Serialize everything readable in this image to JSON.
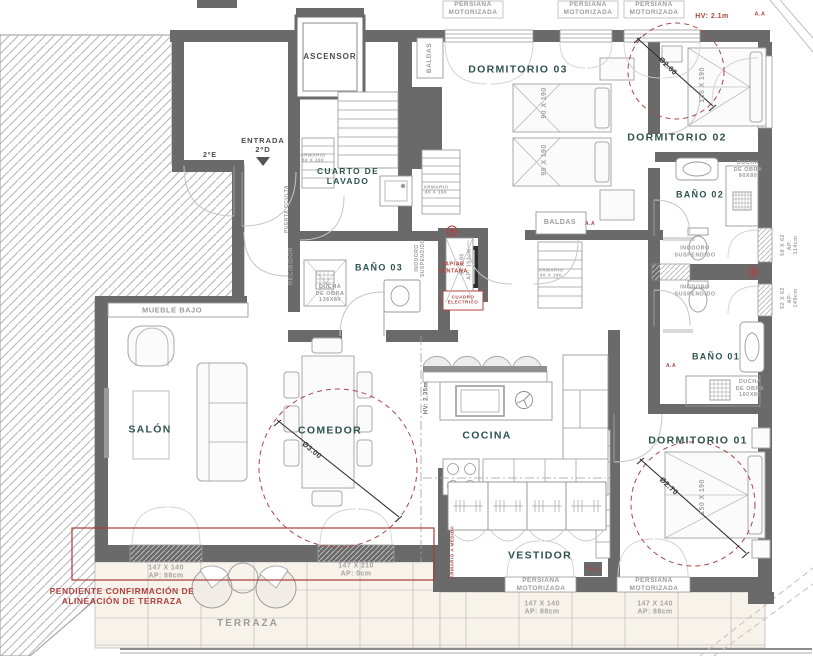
{
  "canvas": {
    "width": 813,
    "height": 656
  },
  "colors": {
    "wall": "#6a6a6a",
    "accent_red": "#b2423e",
    "room_label": "#2e544a",
    "muted_label": "#9c9c9c",
    "tile_bg": "#f7f2ea"
  },
  "labels": [
    {
      "n": "label-salon",
      "c": "room",
      "x": 150,
      "y": 430,
      "t": "SALÓN"
    },
    {
      "n": "label-comedor",
      "c": "room",
      "x": 330,
      "y": 431,
      "t": "COMEDOR"
    },
    {
      "n": "label-cocina",
      "c": "room",
      "x": 487,
      "y": 436,
      "t": "COCINA"
    },
    {
      "n": "label-vestidor",
      "c": "room",
      "x": 540,
      "y": 556,
      "t": "VESTIDOR"
    },
    {
      "n": "label-dormitorio-01",
      "c": "room",
      "x": 698,
      "y": 441,
      "t": "DORMITORIO 01"
    },
    {
      "n": "label-dormitorio-02",
      "c": "room",
      "x": 677,
      "y": 138,
      "t": "DORMITORIO 02"
    },
    {
      "n": "label-dormitorio-03",
      "c": "room",
      "x": 518,
      "y": 70,
      "t": "DORMITORIO 03"
    },
    {
      "n": "label-bano-01",
      "c": "room",
      "x": 716,
      "y": 357,
      "t": "BAÑO 01",
      "fs": 9
    },
    {
      "n": "label-bano-02",
      "c": "room",
      "x": 700,
      "y": 195,
      "t": "BAÑO 02",
      "fs": 9
    },
    {
      "n": "label-bano-03",
      "c": "room",
      "x": 379,
      "y": 268,
      "t": "BAÑO 03",
      "fs": 9
    },
    {
      "n": "label-cuarto-lavado",
      "c": "room",
      "x": 348,
      "y": 176,
      "t": "CUARTO DE\nLAVADO",
      "fs": 8.5
    },
    {
      "n": "label-ascensor",
      "c": "dark",
      "x": 330,
      "y": 57,
      "t": "ASCENSOR"
    },
    {
      "n": "label-entrada",
      "c": "dark",
      "x": 263,
      "y": 145,
      "t": "ENTRADA\n2ºD",
      "fs": 7.5
    },
    {
      "n": "label-piso-2e",
      "c": "dark",
      "x": 210,
      "y": 156,
      "t": "2ºE",
      "fs": 7
    },
    {
      "n": "label-persiana-1",
      "c": "small",
      "x": 473,
      "y": 9,
      "t": "PERSIANA\nMOTORIZADA"
    },
    {
      "n": "label-persiana-2",
      "c": "small",
      "x": 588,
      "y": 9,
      "t": "PERSIANA\nMOTORIZADA"
    },
    {
      "n": "label-persiana-3",
      "c": "small",
      "x": 654,
      "y": 9,
      "t": "PERSIANA\nMOTORIZADA"
    },
    {
      "n": "label-persiana-vestidor",
      "c": "small",
      "x": 541,
      "y": 585,
      "t": "PERSIANA\nMOTORIZADA"
    },
    {
      "n": "label-persiana-dorm01",
      "c": "small",
      "x": 654,
      "y": 585,
      "t": "PERSIANA\nMOTORIZADA"
    },
    {
      "n": "label-mueble-bajo",
      "c": "small",
      "x": 172,
      "y": 310,
      "t": "MUEBLE BAJO",
      "fs": 7.5
    },
    {
      "n": "label-baldas-top",
      "c": "small",
      "x": 430,
      "y": 58,
      "r": -90,
      "t": "BALDAS"
    },
    {
      "n": "label-baldas-mid",
      "c": "small",
      "x": 560,
      "y": 223,
      "t": "BALDAS",
      "fs": 7
    },
    {
      "n": "label-recibidor",
      "c": "small",
      "x": 292,
      "y": 266,
      "r": -90,
      "t": "RECIBIDOR",
      "fs": 6
    },
    {
      "n": "label-puerta-oculta",
      "c": "small",
      "x": 287,
      "y": 209,
      "r": -90,
      "t": "PUERTA OCULTA",
      "fs": 5
    },
    {
      "n": "label-inodoro-b3",
      "c": "small",
      "x": 420,
      "y": 258,
      "r": -90,
      "t": "INODORO\nSUSPENDIDO",
      "fs": 5
    },
    {
      "n": "label-inodoro-b2a",
      "c": "small",
      "x": 695,
      "y": 252,
      "t": "INODORO\nSUSPENDIDO",
      "fs": 5.5
    },
    {
      "n": "label-inodoro-b2b",
      "c": "small",
      "x": 695,
      "y": 291,
      "t": "INODORO\nSUSPENDIDO",
      "fs": 5.5
    },
    {
      "n": "label-ducha-b2",
      "c": "small",
      "x": 748,
      "y": 170,
      "t": "DUCHA\nDE OBRA\n90X80",
      "fs": 5.5
    },
    {
      "n": "label-ducha-b1",
      "c": "small",
      "x": 750,
      "y": 389,
      "t": "DUCHA\nDE OBRA\n160X80",
      "fs": 5.5
    },
    {
      "n": "label-ducha-b3",
      "c": "small",
      "x": 330,
      "y": 294,
      "t": "DUCHA\nDE OBRA\n136X80",
      "fs": 5.5
    },
    {
      "n": "label-armario-lavadero",
      "c": "small",
      "x": 313,
      "y": 158,
      "t": "ARMARIO\n60 X 190",
      "fs": 4.5
    },
    {
      "n": "label-armario-pasillo",
      "c": "small",
      "x": 436,
      "y": 190,
      "t": "ARMARIO\n60 X 190",
      "fs": 4.5
    },
    {
      "n": "label-armario-baldas",
      "c": "small",
      "x": 551,
      "y": 273,
      "t": "ARMARIO\n60 X 190",
      "fs": 4.5
    },
    {
      "n": "label-hv-cocina",
      "c": "smalld",
      "x": 427,
      "y": 398,
      "r": -90,
      "t": "HV: 2.35m"
    },
    {
      "n": "label-terraza",
      "c": "small",
      "x": 248,
      "y": 624,
      "t": "TERRAZA",
      "fs": 10,
      "ls": 2
    },
    {
      "n": "label-cama-d3-1",
      "c": "dim",
      "x": 545,
      "y": 103,
      "r": -90,
      "t": "90 X 190"
    },
    {
      "n": "label-cama-d3-2",
      "c": "dim",
      "x": 545,
      "y": 160,
      "r": -90,
      "t": "90 X 190"
    },
    {
      "n": "label-cama-d2",
      "c": "dim",
      "x": 703,
      "y": 85,
      "r": -90,
      "t": "135 X 190"
    },
    {
      "n": "label-cama-d1",
      "c": "dim",
      "x": 703,
      "y": 497,
      "r": -90,
      "t": "150 X 190"
    },
    {
      "n": "label-ventana-58",
      "c": "dim",
      "x": 790,
      "y": 245,
      "r": -90,
      "t": "58 X 62\nAP: 114cm",
      "fs": 5.5
    },
    {
      "n": "label-ventana-62",
      "c": "dim",
      "x": 790,
      "y": 298,
      "r": -90,
      "t": "62 X 62\nAP: 149cm",
      "fs": 5.5
    },
    {
      "n": "label-ventana-56",
      "c": "dim",
      "x": 466,
      "y": 264,
      "r": -90,
      "t": "56 X 95\nAP: 153cm",
      "fs": 5.5
    },
    {
      "n": "label-ventana-salon",
      "c": "dim",
      "x": 166,
      "y": 573,
      "t": "147 X 140\nAP: 88cm"
    },
    {
      "n": "label-ventana-comedor",
      "c": "dim",
      "x": 356,
      "y": 571,
      "t": "147 X 210\nAP: 0cm"
    },
    {
      "n": "label-ventana-vestidor",
      "c": "dim",
      "x": 542,
      "y": 609,
      "t": "147 X 140\nAP: 88cm"
    },
    {
      "n": "label-ventana-dorm01",
      "c": "dim",
      "x": 655,
      "y": 609,
      "t": "147 X 140\nAP: 88cm"
    },
    {
      "n": "label-diametro-200",
      "c": "diam",
      "x": 668,
      "y": 66,
      "r": 44,
      "t": "Ø2.00"
    },
    {
      "n": "label-diametro-300",
      "c": "diam",
      "x": 312,
      "y": 450,
      "r": 39,
      "t": "Ø3.00"
    },
    {
      "n": "label-diametro-270",
      "c": "diam",
      "x": 669,
      "y": 486,
      "r": 43,
      "t": "Ø2.70"
    },
    {
      "n": "label-hv-dorm02",
      "c": "red",
      "x": 712,
      "y": 17,
      "t": "HV: 2.1m",
      "fs": 7
    },
    {
      "n": "label-tapiar-ventana",
      "c": "red",
      "x": 453,
      "y": 268,
      "t": "TAPIAR\nVENTANA",
      "fs": 5.5
    },
    {
      "n": "label-cuadro-electrico",
      "c": "red",
      "x": 463,
      "y": 300,
      "t": "CUADRO\nELECTRICO",
      "fs": 4.5
    },
    {
      "n": "label-pendiente-terraza",
      "c": "red",
      "x": 122,
      "y": 596,
      "t": "PENDIENTE CONFIRMACIÓN DE\nALINEACIÓN DE TERRAZA",
      "fs": 8.5
    },
    {
      "n": "label-armario-medida",
      "c": "red",
      "x": 452,
      "y": 552,
      "r": -90,
      "t": "ARMARIO A MEDIDA",
      "fs": 4.5
    },
    {
      "n": "label-aa-baldas",
      "c": "red",
      "x": 590,
      "y": 224,
      "t": "A.A",
      "fs": 5
    },
    {
      "n": "label-aa-vestidor",
      "c": "red",
      "x": 594,
      "y": 570,
      "t": "A.A",
      "fs": 5.5
    },
    {
      "n": "label-aa-bano1",
      "c": "red",
      "x": 671,
      "y": 366,
      "t": "A.A",
      "fs": 5
    },
    {
      "n": "label-aa-dorm02",
      "c": "red",
      "x": 760,
      "y": 15,
      "t": "A.A",
      "fs": 5.5
    }
  ]
}
